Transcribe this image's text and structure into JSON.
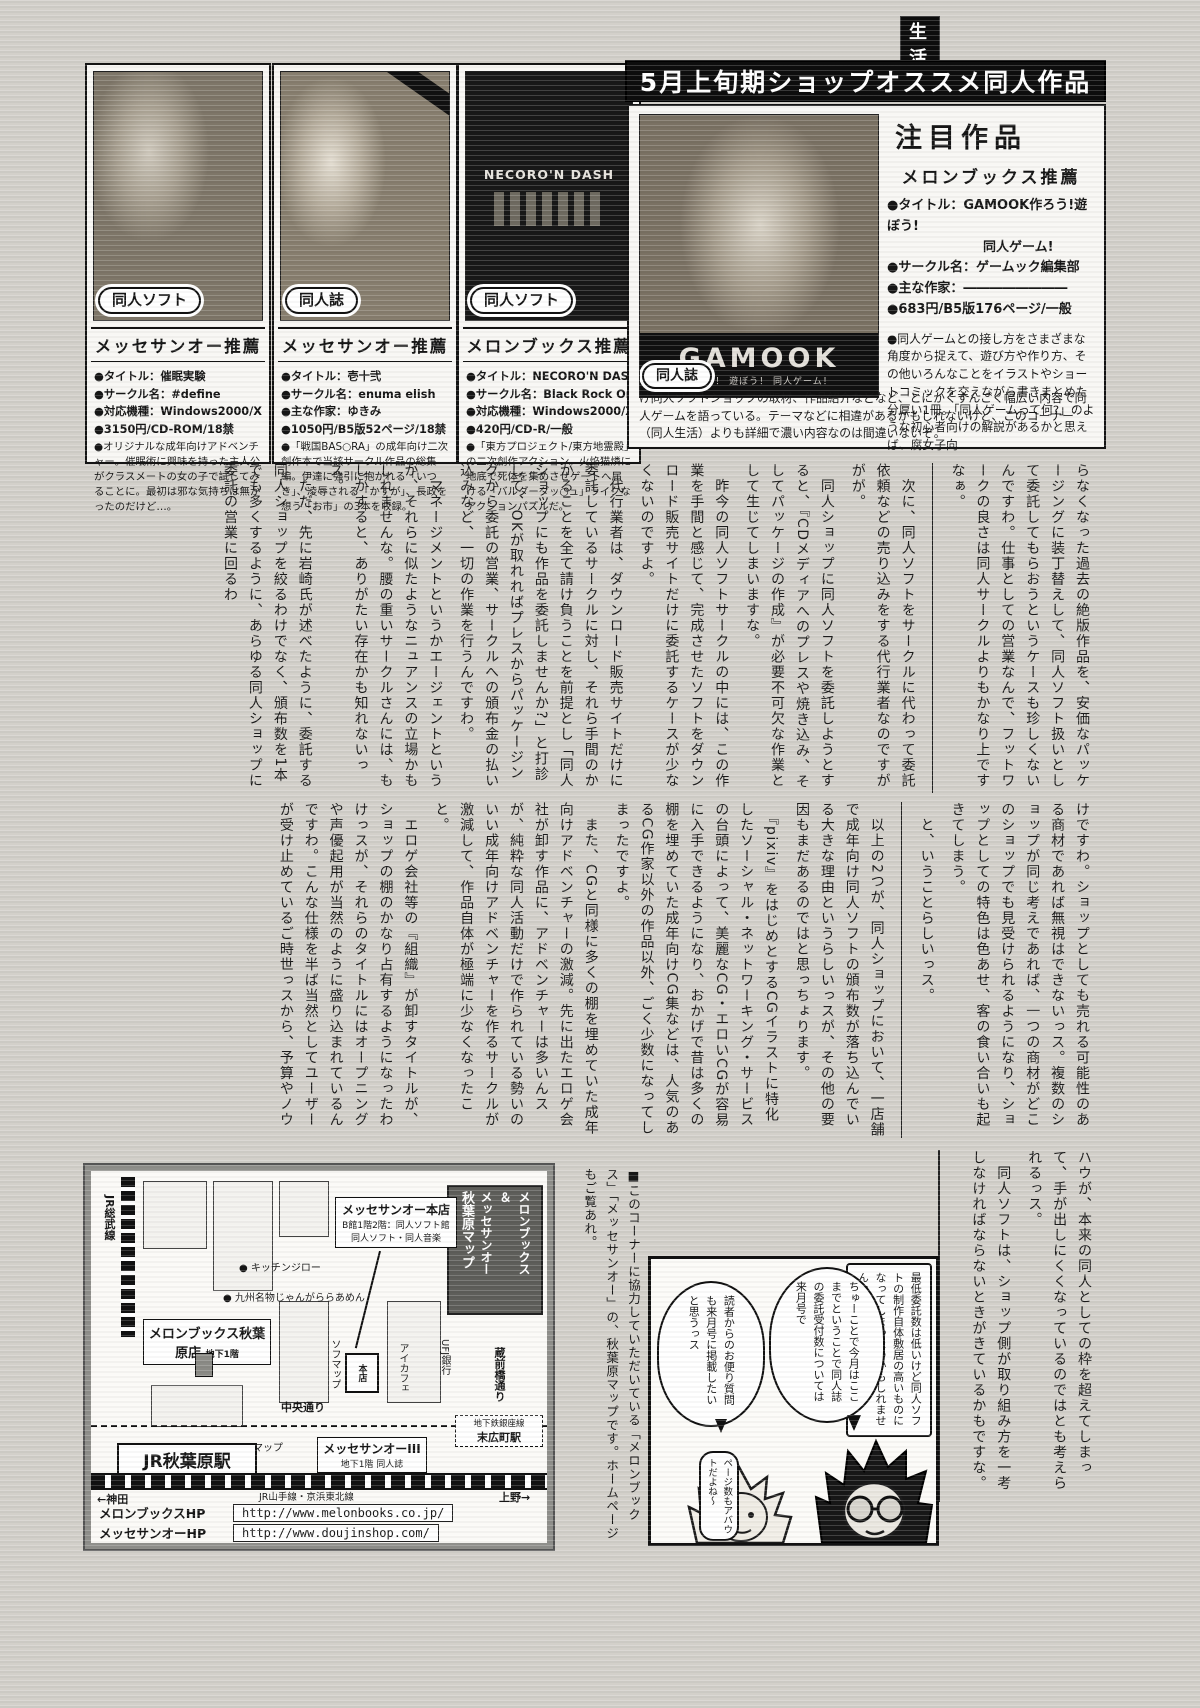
{
  "page_tag": {
    "left": "同人",
    "right": "生活"
  },
  "top_banner": "5月上旬期ショップオススメ同人作品",
  "boxes": [
    {
      "type_label": "同人ソフト",
      "shop": "メッセサンオー推薦",
      "lines": [
        "●タイトル：催眠実験",
        "●サークル名：#define",
        "●対応機種：Windows2000/Xp/Vista",
        "●3150円/CD-ROM/18禁"
      ],
      "desc": "●オリジナルな成年向けアドベンチャー。催眠術に興味を持った主人公がクラスメートの女の子で試してみることに。最初は邪な気持ちは無かったのだけど…。"
    },
    {
      "type_label": "同人誌",
      "shop": "メッセサンオー推薦",
      "lines": [
        "●タイトル：壱十弐",
        "●サークル名：enuma elish",
        "●主な作家：ゆきみ",
        "●1050円/B5版52ページ/18禁"
      ],
      "desc": "●「戦国BAS○RA」の成年向け二次創作本で当該サークル作品の総集編。伊達に強引に抱かれる「いつき」、凌辱される「かすが」、長政を想う「お市」の3本を収録。"
    },
    {
      "type_label": "同人ソフト",
      "shop": "メロンブックス推薦",
      "cover_title": "NECORO'N DASH",
      "lines": [
        "●タイトル：NECORO'N DASH",
        "●サークル名：Black Rock One",
        "●対応機種：Windows2000/Xp/Vista",
        "●420円/CD-R/一般"
      ],
      "desc": "●「東方プロジェクト/東方地霊殿」の二次創作アクション。火焔猫燐に地底で死体を集めさせゲートへ届ける「バルダーダッ○ュ」ライクなアクションパズルだ。"
    }
  ],
  "featured": {
    "title": "注目作品",
    "shop": "メロンブックス推薦",
    "type_label": "同人誌",
    "cover_title": "GAMOOK",
    "cover_sub": "作ろう！ 遊ぼう！ 同人ゲーム！",
    "lines": [
      "●タイトル：GAMOOK作ろう!遊ぼう!",
      "同人ゲーム!",
      "●サークル名：ゲームック編集部",
      "●主な作家：――――――――",
      "●683円/B5版176ページ/一般"
    ],
    "desc1": "●同人ゲームとの接し方をさまざまな角度から捉えて、遊び方や作り方、その他いろんなことをイラストやショートコミックを交えながら書きまとめた分厚い1冊。「同人ゲームって何?」のような初心者向けの解説があるかと思えば、腐女子向",
    "desc2": "け同人ソフトショップの取材、作品紹介などなど、とにかくすんごく幅広い内容で同人ゲームを語っている。テーマなどに相違があるかもしれないけど、このコーナー（同人生活）よりも詳細で濃い内容なのは間違いないぞ。"
  },
  "article": {
    "band1": [
      "らなくなった過去の絶版作品を、安価なパッケージングに装丁替えして、同人ソフト扱いとして委託してもらおうというケースも珍しくないんですわ。仕事としての営業なんで、フットワークの良さは同人サークルよりもかなり上ですなぁ。",
      "　次に、同人ソフトをサークルに代わって委託依頼などの売り込みをする代行業者なのですががが。",
      "　同人ショップに同人ソフトを委託しようとすると、『CDメディアへのプレスや焼き込み、そしてパッケージの作成』が必要不可欠な作業として生じてしまいますな。",
      "　昨今の同人ソフトサークルの中には、この作業を手間と感じて、完成させたソフトをダウンロード販売サイトだけに委託するケースが少なくないのですよ。",
      "　代行業者は、ダウンロード販売サイトだけに委託しているサークルに対し、それら手間のかかることを全て請け負うことを前提とし「同人ショップにも作品を委託しませんか?」と打診して、OKが取れればプレスからパッケージングから委託の営業、サークルへの頒布金の払い込みなど、一切の作業を行うんですわ。",
      "　マネージメントというかエージェントというか、それらに似たようなニュアンスの立場かもしれませんな。腰の重いサークルさんには、もしかすると、ありがたい存在かも知れないっス。",
      "　ただ、先に岩崎氏が述べたように、委託する同人ショップを絞るわけでなく、頒布数を1本でも多くするように、あらゆる同人ショップに委託の営業に回るわ"
    ],
    "band2": [
      "けですわ。ショップとしても売れる可能性のある商材であれば無視はできないっス。複数のショップが同じ考えであれば、一つの商材がどこのショップでも見受けられるようになり、ショップとしての特色は色あせ、客の食い合いも起きてしまう。",
      "　と、いうことらしいっス。",
      "　以上の2つが、同人ショップにおいて、一店舗で成年向け同人ソフトの頒布数が落ち込んでいる大きな理由というらしいっスが、その他の要因もまだあるのではと思っちょります。",
      "　『pixiv』をはじめとするCGイラストに特化したソーシャル・ネットワーキング・サービスの台頭によって、美麗なCG・エロいCGが容易に入手できるようになり、おかげで昔は多くの棚を埋めていた成年向けCG集などは、人気のあるCG作家以外の作品以外、ごく少数になってしまったですよ。",
      "　また、CGと同様に多くの棚を埋めていた成年向けアドベンチャーの激減。先に出たエロゲ会社が卸す作品に、アドベンチャーは多いんスが、純粋な同人活動だけで作られている勢いのいい成年向けアドベンチャーを作るサークルが激減して、作品自体が極端に少なくなったこと。",
      "　エロゲ会社等の『組織』が卸すタイトルが、ショップの棚のかなり占有するようになったわけっスが、それらのタイトルにはオープニングや声優起用が当然のように盛り込まれているんですわ。こんな仕様を半ば当然としてユーザーが受け止めているご時世っスから、予算やノウ"
    ],
    "band3": [
      "ハウが、本来の同人としての枠を超えてしまって、手が出しにくくなっているのではとも考えられるっス。",
      "　同人ソフトは、ショップ側が取り組み方を一考しなければならないときがきているかもですな。"
    ]
  },
  "map": {
    "title_line1": "メロンブックス",
    "title_amp": "＆",
    "title_line2": "メッセサンオー",
    "title_line3": "秋葉原マップ",
    "jr_sobu": "JR総武線",
    "melon_store": "メロンブックス秋葉原店",
    "melon_floor": "地下1階",
    "kitchen_jiro": "キッチンジロー",
    "janga": "九州名物じゃんがららあめん",
    "messe_honten": "メッセサンオー本店",
    "messe_honten_sub1": "B館1階2階：同人ソフト館",
    "messe_honten_sub2": "同人ソフト・同人音楽",
    "sofmap1": "ソフマップ",
    "honten": "本店",
    "aicafe": "アイカフェ",
    "ufj": "UFJ銀行",
    "kuramae": "蔵前橋通り",
    "chuo_dori": "中央通り",
    "ginza_line": "地下鉄銀座線",
    "suehirocho": "末広町駅",
    "sofmap2": "ソフマップ",
    "messe3": "メッセサンオーIII",
    "messe3_sub": "地下1階 同人誌",
    "akihabara_sta": "JR秋葉原駅",
    "yamanote": "JR山手線・京浜東北線",
    "kanda": "←神田",
    "ueno": "上野→",
    "urls": [
      {
        "label": "メロンブックスHP",
        "url": "http://www.melonbooks.co.jp/"
      },
      {
        "label": "メッセサンオーHP",
        "url": "http://www.doujinshop.com/"
      }
    ],
    "note": "■このコーナーに協力していただいている「メロンブックス」「メッセサンオー」の、秋葉原マップです。ホームページもご覧あれ。"
  },
  "manga": {
    "caption": "最低委託数は低いけど同人ソフトの制作自体敷居の高いものになってしまったのかもしれませんなぁ",
    "bubble_mid": "ちゅーことで今月はここまでということで同人誌の委託受付数については来月号で",
    "bubble_left": "読者からのお便り質問も来月号に掲載したいと思うっス",
    "bubble_small": "ページ数もアバウトだよね〜"
  }
}
